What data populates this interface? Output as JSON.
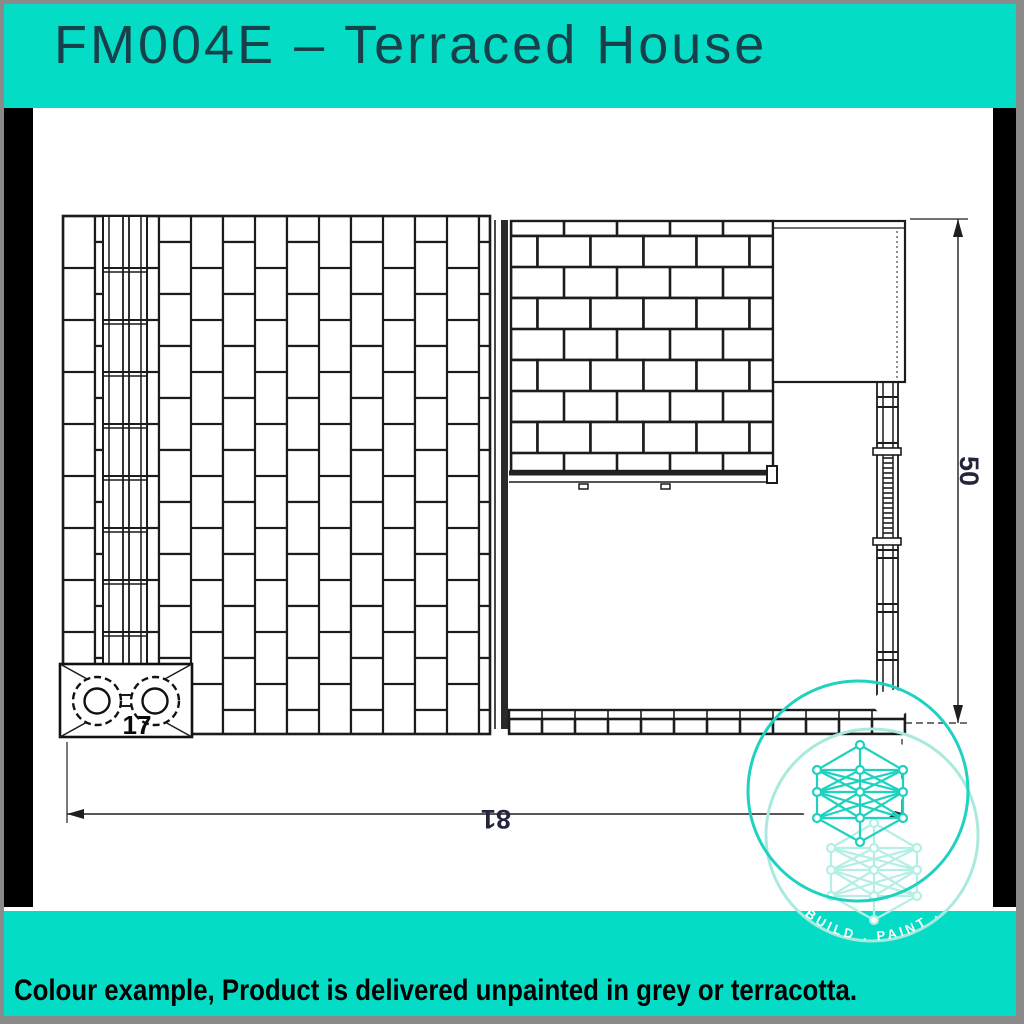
{
  "header": {
    "title": "FM004E – Terraced House"
  },
  "footer": {
    "note": "Colour example, Product is delivered unpainted in grey or terracotta."
  },
  "drawing": {
    "kind": "technical elevation drawing of a terraced house model kit (roof tile panel, brick wall panel, chimney with two pots, gutter and downpipe)",
    "dimension_labels": {
      "chimney_width": "17",
      "overall_width": "81",
      "overall_height": "50"
    },
    "watermark": {
      "arc_text": "NT . BUILD . PAINT . REP"
    }
  },
  "colors": {
    "band_teal": "#05dcc5",
    "header_text": "#16414b",
    "footer_text": "#000000",
    "pillar_black": "#000000",
    "frame_grey": "#8a8a8a",
    "line_ink": "#1c1c1c",
    "dim_text": "#23263a",
    "watermark_teal": "#1fd2bf",
    "watermark_faint": "#aaeade"
  }
}
